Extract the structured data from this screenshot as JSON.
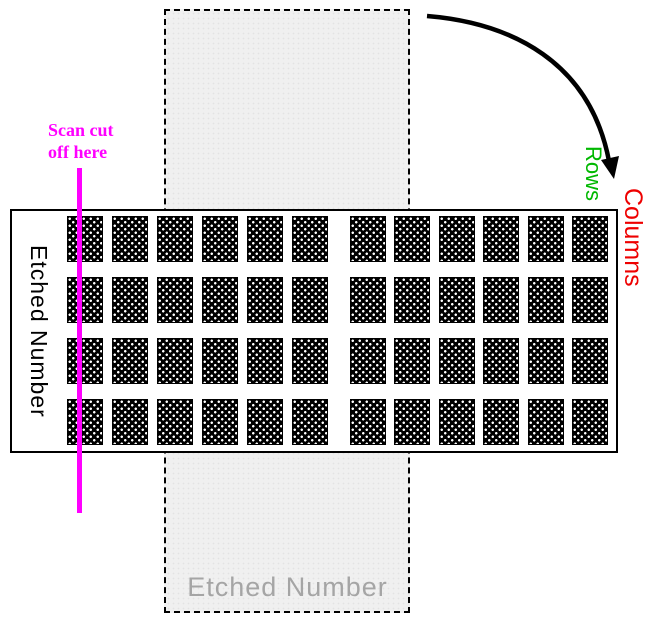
{
  "diagram": {
    "scan_note": {
      "line1": "Scan cut",
      "line2": "off here"
    },
    "slide_label": "Etched Number",
    "etched_area_label": "Etched Number",
    "rows_label": "Rows",
    "columns_label": "Columns"
  },
  "colors": {
    "scan-note": "#ff00ff",
    "rows": "#00b800",
    "columns": "#ee0000",
    "etched-area-text": "#a5a5a5",
    "etched-area-fill": "#f0f0f0",
    "arrow": "#000000"
  },
  "grid": {
    "rows": 4,
    "columns": 12,
    "column_group_gap_after": 6,
    "pad_width": 36,
    "pad_height": 46,
    "col_x": [
      67,
      112,
      157,
      202,
      247,
      292,
      350,
      394,
      439,
      483,
      528,
      572
    ],
    "row_y": [
      216,
      277,
      338,
      399
    ]
  }
}
